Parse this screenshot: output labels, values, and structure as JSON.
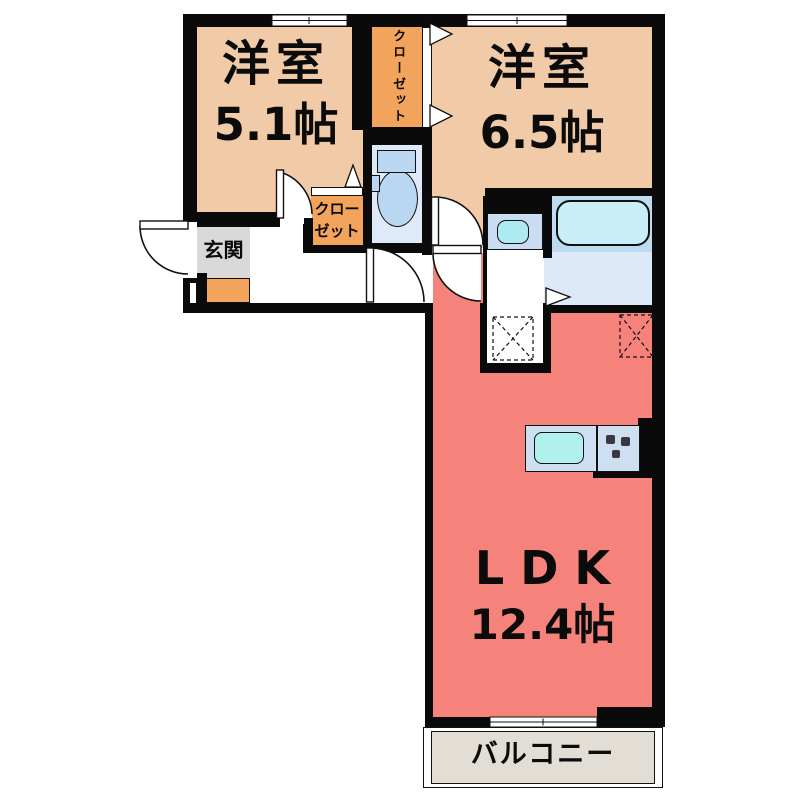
{
  "rooms": {
    "bedroom_left": {
      "name": "洋室",
      "area": "5.1帖"
    },
    "bedroom_right": {
      "name": "洋室",
      "area": "6.5帖"
    },
    "ldk": {
      "name": "LDK",
      "area": "12.4帖"
    },
    "entrance": {
      "name": "玄関"
    },
    "closet_upper": {
      "name": "クローゼット"
    },
    "closet_lower": {
      "line1": "クロー",
      "line2": "ゼット"
    },
    "balcony": {
      "name": "バルコニー"
    }
  },
  "fixtures": {
    "toilet": "toilet-icon",
    "bathtub": "bathtub-icon",
    "washbasin": "washbasin-icon",
    "kitchen_sink": "kitchen-sink-icon",
    "stove": "stove-burner-dots-icon",
    "floor_markers": "dashed-x-square-marker"
  },
  "colors": {
    "wall": "#0a0a0a",
    "bedroom": "#f1cba7",
    "closet": "#f2a35c",
    "ldk": "#f5827b",
    "toilet-room": "#dfeaf8",
    "bath-room": "#bedcf0",
    "washroom": "#dce9f7",
    "bathtub": "#c9eef8",
    "fixture": "#bad7f2",
    "basin-unit": "#cadcf2",
    "basin": "#aeeaf2",
    "counter": "#cfdff2",
    "sink": "#b0f0ee",
    "entrance-floor": "#d9d9d9",
    "balcony-floor": "#e3ded5"
  }
}
